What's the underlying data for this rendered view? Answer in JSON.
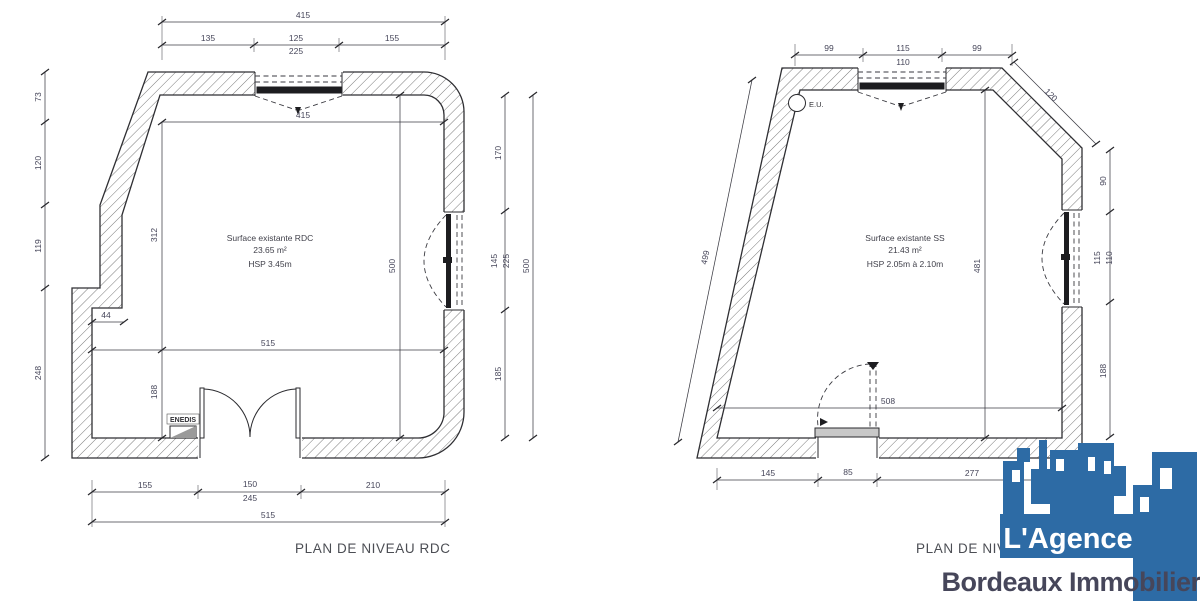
{
  "colors": {
    "background": "#ffffff",
    "line": "#2f2f33",
    "dim_text": "#46465a",
    "logo_blue": "#2d6ba5"
  },
  "rdc": {
    "title": "PLAN DE NIVEAU RDC",
    "room": {
      "l1": "Surface existante RDC",
      "l2": "23.65 m²",
      "l3": "HSP 3.45m"
    },
    "enedis": "ENEDIS",
    "dims": {
      "top_total": "415",
      "top_135": "135",
      "top_125": "125",
      "top_225": "225",
      "top_155": "155",
      "left_73": "73",
      "left_120": "120",
      "left_119": "119",
      "left_248": "248",
      "right_170": "170",
      "right_145": "145",
      "right_225": "225",
      "right_185": "185",
      "right_500": "500",
      "bottom_155": "155",
      "bottom_150": "150",
      "bottom_245": "245",
      "bottom_210": "210",
      "bottom_515": "515",
      "in_415": "415",
      "in_312": "312",
      "in_188": "188",
      "in_500": "500",
      "in_515": "515",
      "in_44": "44"
    }
  },
  "ss": {
    "title": "PLAN DE NIVEAU SOUS-SOL",
    "room": {
      "l1": "Surface existante SS",
      "l2": "21.43 m²",
      "l3": "HSP 2.05m à 2.10m"
    },
    "eu": "E.U.",
    "dims": {
      "top_99a": "99",
      "top_115": "115",
      "top_110": "110",
      "top_99b": "99",
      "right_120": "120",
      "right_90": "90",
      "right_115": "115",
      "right_110": "110",
      "right_188": "188",
      "left_499": "499",
      "in_481": "481",
      "in_508": "508",
      "bottom_145": "145",
      "bottom_85": "85",
      "bottom_277": "277"
    }
  },
  "logo": {
    "line1": "L'Agence",
    "line2": "Bordeaux Immobilier"
  }
}
